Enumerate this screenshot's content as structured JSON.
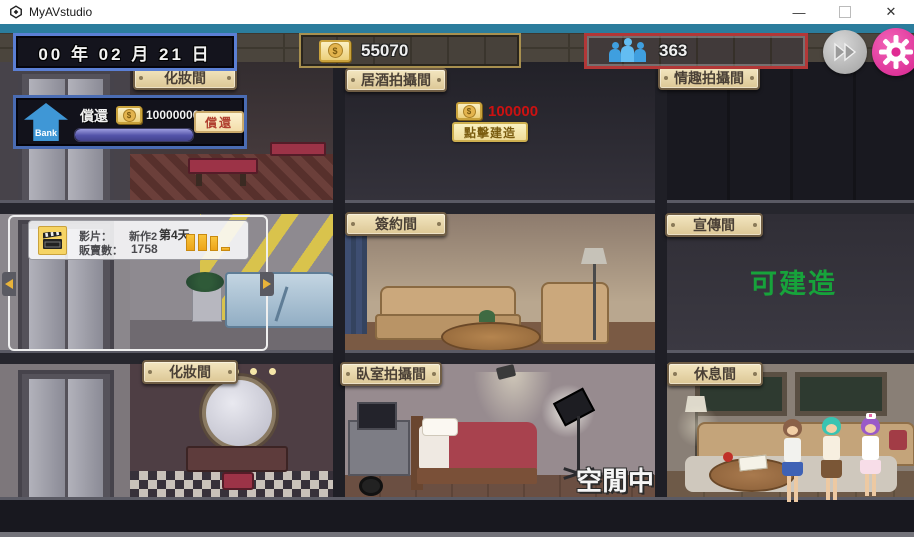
{
  "window": {
    "title": "MyAVstudio",
    "minimize": "—",
    "close": "✕"
  },
  "hud": {
    "date": "00 年 02 月 21 日",
    "money": "55070",
    "population": "363"
  },
  "bank": {
    "name": "Bank",
    "label": "償還",
    "amount": "100000000",
    "button": "償還"
  },
  "film": {
    "title_label": "影片：",
    "title": "新作2",
    "day": "第4天",
    "sales_label": "販賣數：",
    "sales": "1758",
    "bars": [
      17,
      17,
      15,
      4
    ]
  },
  "build": {
    "cost": "100000",
    "button": "點擊建造"
  },
  "rooms": {
    "f1r1": "化妝間",
    "f1r2": "居酒拍攝間",
    "f1r3": "情趣拍攝間",
    "f2r2": "簽約間",
    "f2r3": "宣傳間",
    "f3r1": "化妝間",
    "f3r2": "臥室拍攝間",
    "f3r3": "休息間"
  },
  "status": {
    "buildable": "可建造",
    "idle": "空閒中"
  }
}
